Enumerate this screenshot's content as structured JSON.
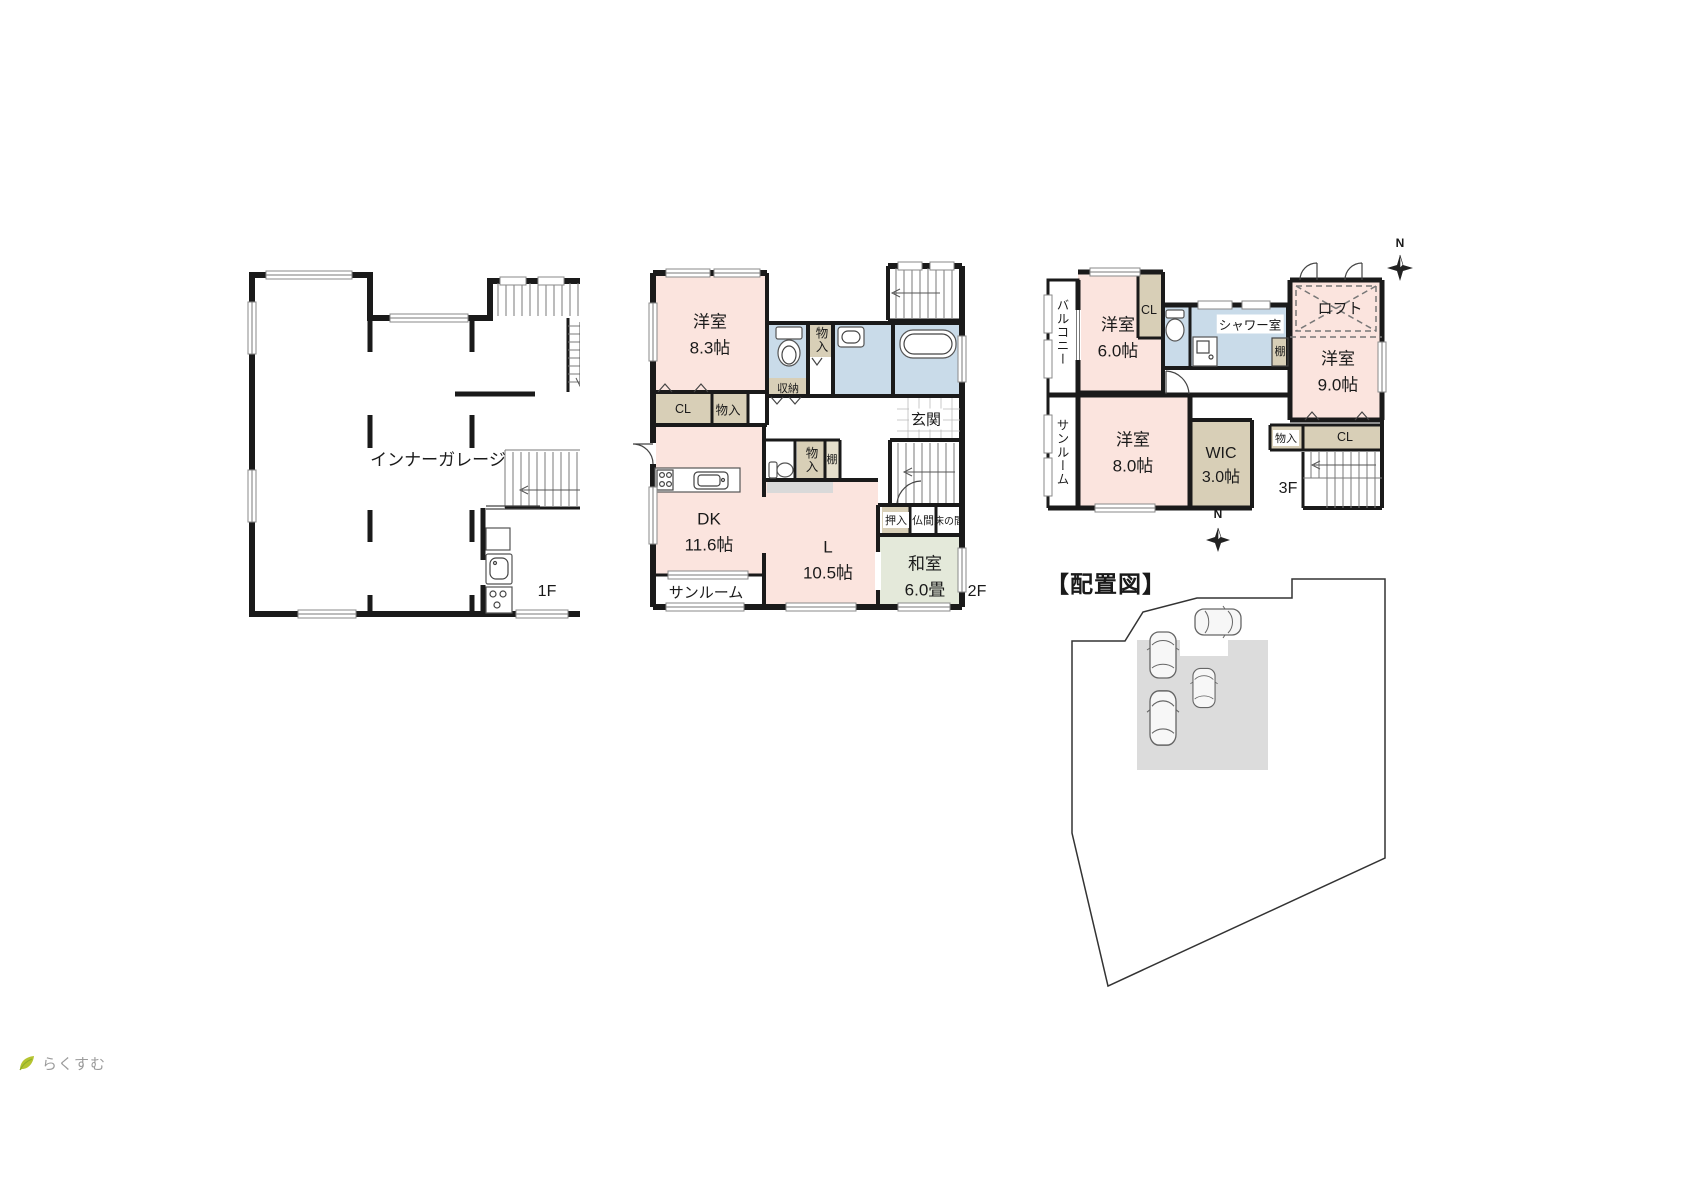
{
  "logo": {
    "brand": "らくすむ"
  },
  "floor1": {
    "label": "1F",
    "garage_label": "インナーガレージ"
  },
  "floor2": {
    "label": "2F",
    "western_room": {
      "name": "洋室",
      "size": "8.3帖"
    },
    "closet": "CL",
    "storage_a": "物入",
    "shuno": "収納",
    "storage_hall": "物入",
    "genkan": "玄関",
    "storage_b": "物入",
    "shelf": "棚",
    "dk": {
      "name": "DK",
      "size": "11.6帖"
    },
    "living": {
      "name": "L",
      "size": "10.5帖"
    },
    "sunroom": "サンルーム",
    "oshiire": "押入",
    "butsuma": "仏間",
    "tokonoma": "床の間",
    "washitsu": {
      "name": "和室",
      "size": "6.0畳"
    }
  },
  "floor3": {
    "label": "3F",
    "balcony": "バルコニー",
    "west_room_6": {
      "name": "洋室",
      "size": "6.0帖"
    },
    "closet_a": "CL",
    "shower_room": "シャワー室",
    "shelf": "棚",
    "loft": "ロフト",
    "west_room_9": {
      "name": "洋室",
      "size": "9.0帖"
    },
    "sunroom": "サンルーム",
    "west_room_8": {
      "name": "洋室",
      "size": "8.0帖"
    },
    "wic": {
      "name": "WIC",
      "size": "3.0帖"
    },
    "storage": "物入",
    "closet_b": "CL",
    "compass_n": "N"
  },
  "site": {
    "title": "【配置図】",
    "compass_n": "N",
    "car_count": 4
  },
  "colors": {
    "room_pink": "#fbe4de",
    "tatami_green": "#e4e9da",
    "wet_blue": "#c9dbe9",
    "closet_tan": "#d8cfb7",
    "shelf_gray": "#d9d9d9",
    "site_building_gray": "#dcdcdc",
    "wall_black": "#1a1a1a",
    "logo_green": "#b5c431",
    "logo_text_gray": "#9b9b9b"
  }
}
